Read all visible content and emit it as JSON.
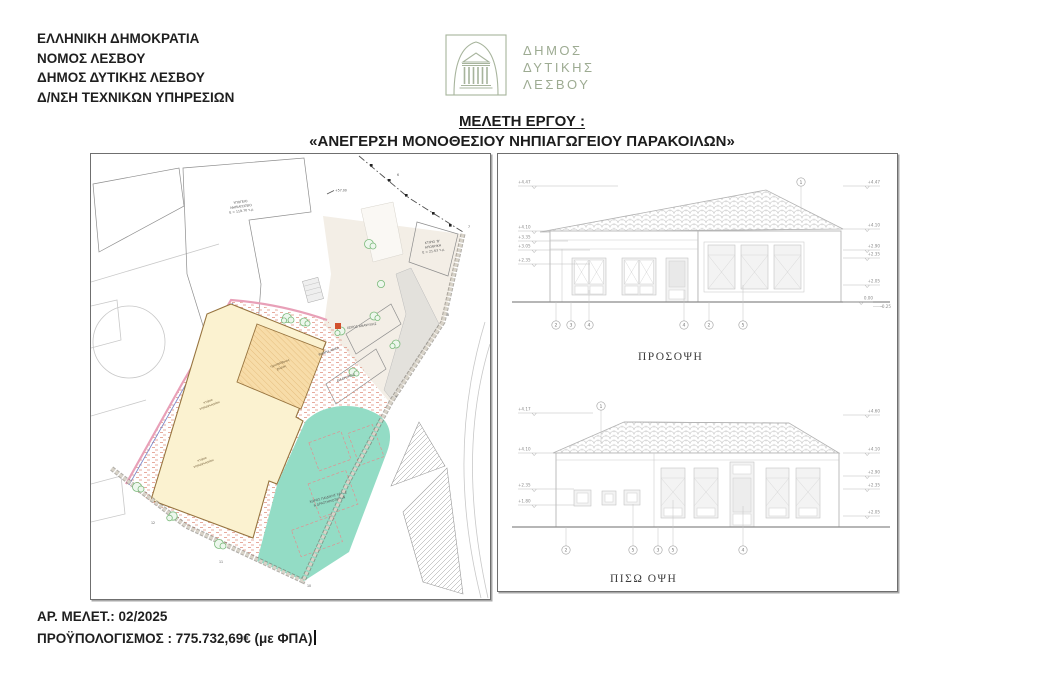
{
  "header": {
    "lines": [
      "ΕΛΛΗΝΙΚΗ ΔΗΜΟΚΡΑΤΙΑ",
      "ΝΟΜΟΣ ΛΕΣΒΟΥ",
      "ΔΗΜΟΣ ΔΥΤΙΚΗΣ ΛΕΣΒΟΥ",
      "Δ/ΝΣΗ ΤΕΧΝΙΚΩΝ ΥΠΗΡΕΣΙΩΝ"
    ],
    "logo": {
      "icon": "temple-arch-emblem",
      "color": "#9dab92",
      "lines": [
        "ΔΗΜΟΣ",
        "ΔΥΤΙΚΗΣ",
        "ΛΕΣΒΟΥ"
      ]
    }
  },
  "title": {
    "kicker": "ΜΕΛΕΤΗ ΕΡΓΟΥ :",
    "name": "«ΑΝΕΓΕΡΣΗ ΜΟΝΟΘΕΣΙΟΥ ΝΗΠΙΑΓΩΓΕΙΟΥ ΠΑΡΑΚΟΙΛΩΝ»"
  },
  "site_plan": {
    "labels": {
      "underground_l1": "ΥΠΟΓΕΙΟ",
      "underground_l2": "ΝΗΠΙΑΓΩΓΕΙΟ",
      "underground_l3": "Ε = 119.70 τ.μ.",
      "storage_l1": "ΚΤΙΡΙΟ 'Β'",
      "storage_l2": "ΑΠΟΘΗΚΗ",
      "storage_l3": "Ε = 21.63 τ.μ.",
      "spot_elevation": "+57.00",
      "recreation": "ΧΩΡΟΣ ΑΝΑΨΥΧΗΣ",
      "ramp": "ΡΑΜΠΑ ΑΜΕΑ",
      "corridor": "ΔΙΑΔΡΟΜΟΣ",
      "building_l1": "κτίριο",
      "building_l2": "νηπιαγωγείου",
      "semi_open_l1": "ημιυπαίθριος",
      "semi_open_l2": "χώρος",
      "playground_l1": "ΧΩΡΟΣ ΠΑΙΔΙΚΗΣ ΧΑΡΑΣ",
      "playground_l2": "& ΔΡΑΣΤΗΡΙΟΤΗΤΩΝ"
    },
    "vertices": {
      "v6": "6",
      "v7": "7",
      "v8": "8",
      "v9": "9",
      "v10": "10",
      "v11": "11",
      "v12": "12"
    },
    "colors": {
      "building_fill": "#fbf2d0",
      "semi_open_fill": "#f7dca8",
      "playground_fill": "#93dcc5",
      "courtyard_hatch": "#e0907e",
      "accent_square": "#d2512e"
    }
  },
  "elevations": {
    "front": {
      "caption": "ΠΡΟΣΟΨΗ",
      "roof_callout": "1",
      "markers_left": [
        "+4.47",
        "+4.10",
        "+3.35",
        "+3.05",
        "+2.35"
      ],
      "markers_right": [
        "+4.47",
        "+4.10",
        "+2.90",
        "+2.35",
        "+2.05",
        "0.00",
        "-0.25"
      ],
      "bubbles": [
        "2",
        "3",
        "4",
        "4",
        "2",
        "5"
      ]
    },
    "back": {
      "caption": "ΠΙΣΩ ΟΨΗ",
      "roof_callout": "1",
      "markers_left": [
        "+4.17",
        "+4.10",
        "+2.35",
        "+1.80"
      ],
      "markers_right": [
        "+4.60",
        "+4.10",
        "+2.90",
        "+2.35",
        "+2.05"
      ],
      "bubbles": [
        "2",
        "5",
        "3",
        "5",
        "4"
      ]
    }
  },
  "footer": {
    "study_no": "ΑΡ. ΜΕΛΕΤ.: 02/2025",
    "budget": "ΠΡΟΫΠΟΛΟΓΙΣΜΟΣ : 775.732,69€ (με ΦΠΑ)"
  }
}
